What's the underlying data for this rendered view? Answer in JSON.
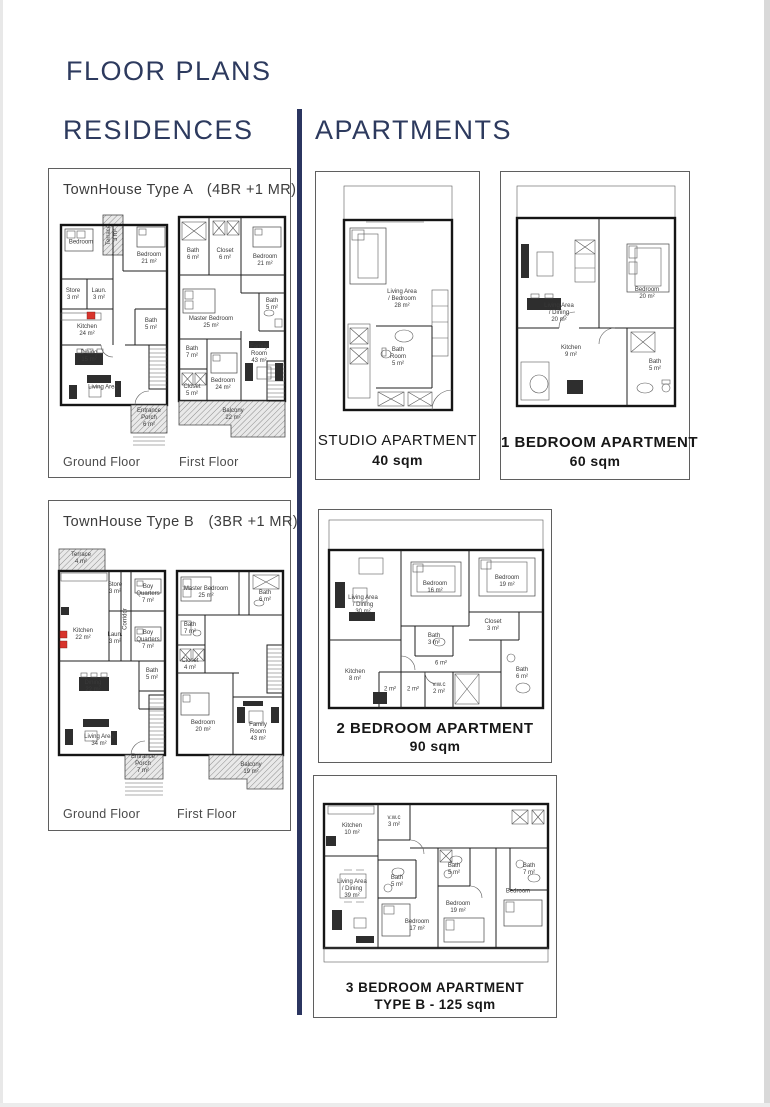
{
  "page": {
    "title": "FLOOR PLANS",
    "left_section": "RESIDENCES",
    "right_section": "APARTMENTS"
  },
  "colors": {
    "heading_navy": "#2d3a5e",
    "divider_navy": "#2b3560",
    "wall_black": "#151515",
    "accent_red": "#d8342c"
  },
  "townhouse_a": {
    "title": "TownHouse Type A",
    "config": "(4BR +1 MR)",
    "ground_floor_label": "Ground Floor",
    "first_floor_label": "First Floor",
    "ground_rooms": {
      "bedroom_tl": "Bedroom",
      "terrace": "Terrace\n3 m²",
      "bedroom_tr": "Bedroom\n21 m²",
      "store": "Store\n3 m²",
      "laundry": "Laun.\n3 m²",
      "kitchen": "Kitchen\n24 m²",
      "bath": "Bath\n5 m²",
      "dining": "Dining\n15 m²",
      "living": "Living Area",
      "porch": "Entrance Porch\n6 m²"
    },
    "first_rooms": {
      "bath1": "Bath\n6 m²",
      "closet1": "Closet\n6 m²",
      "bedroom_tr": "Bedroom\n21 m²",
      "master_bedroom": "Master Bedroom\n25 m²",
      "bath2": "Bath\n5 m²",
      "bath3": "Bath\n7 m²",
      "closet2": "Closet\n5 m²",
      "bedroom_b": "Bedroom\n24 m²",
      "family_room": "Family Room\n43 m²",
      "balcony": "Balcony\n22 m²"
    }
  },
  "townhouse_b": {
    "title": "TownHouse Type B",
    "config": "(3BR +1 MR)",
    "ground_floor_label": "Ground Floor",
    "first_floor_label": "First Floor",
    "ground_rooms": {
      "terrace": "Terrace\n4 m²",
      "store": "Store\n3 m²",
      "boy_quarters1": "Boy Quarters\n7 m²",
      "boy_quarters2": "Boy Quarters\n7 m²",
      "kitchen": "Kitchen\n22 m²",
      "laundry": "Laun.\n3 m²",
      "corridor": "Corridor",
      "bath": "Bath\n5 m²",
      "dining": "Dining\n22 m²",
      "living": "Living Area\n34 m²",
      "porch": "Entrance Porch\n7 m²"
    },
    "first_rooms": {
      "master_bedroom": "Master Bedroom\n25 m²",
      "bath1": "Bath\n6 m²",
      "bath2": "Bath\n7 m²",
      "closet": "Closet\n4 m²",
      "bedroom": "Bedroom\n20 m²",
      "family_room": "Family Room\n43 m²",
      "balcony": "Balcony\n19 m²"
    }
  },
  "studio": {
    "caption_title": "STUDIO APARTMENT",
    "caption_area": "40 sqm",
    "rooms": {
      "living_bedroom": "Living Area\n/ Bedroom\n28 m²",
      "bath_room": "Bath\nRoom\n5 m²"
    }
  },
  "one_bedroom": {
    "caption_title": "1 BEDROOM APARTMENT",
    "caption_area": "60 sqm",
    "rooms": {
      "living_dining": "Living Area\n/ Dining\n20 m²",
      "bedroom": "Bedroom\n20 m²",
      "kitchen": "Kitchen\n9 m²",
      "bath": "Bath\n5 m²"
    }
  },
  "two_bedroom": {
    "caption_title": "2 BEDROOM APARTMENT",
    "caption_area": "90 sqm",
    "rooms": {
      "living_dining": "Living Area\n/ Dining\n30 m²",
      "bedroom1": "Bedroom\n16 m²",
      "bedroom2": "Bedroom\n19 m²",
      "bath1": "Bath\n3 m²",
      "hall": "6 m²",
      "closet": "Closet\n3 m²",
      "kitchen": "Kitchen\n8 m²",
      "store1": "2 m²",
      "store2": "2 m²",
      "vwc": "v.w.c\n2 m²",
      "bath2": "Bath\n6 m²"
    }
  },
  "three_bedroom": {
    "caption_title": "3 BEDROOM APARTMENT",
    "caption_area": "TYPE B - 125 sqm",
    "rooms": {
      "kitchen": "Kitchen\n10 m²",
      "vwc": "v.w.c\n3 m²",
      "living_dining": "Living Area\n/ Dining\n39 m²",
      "bath1": "Bath\n5 m²",
      "bath2": "Bath\n5 m²",
      "bath3": "Bath\n7 m²",
      "bedroom1": "Bedroom\n17 m²",
      "bedroom2": "Bedroom\n19 m²",
      "bedroom3": "Bedroom"
    }
  }
}
